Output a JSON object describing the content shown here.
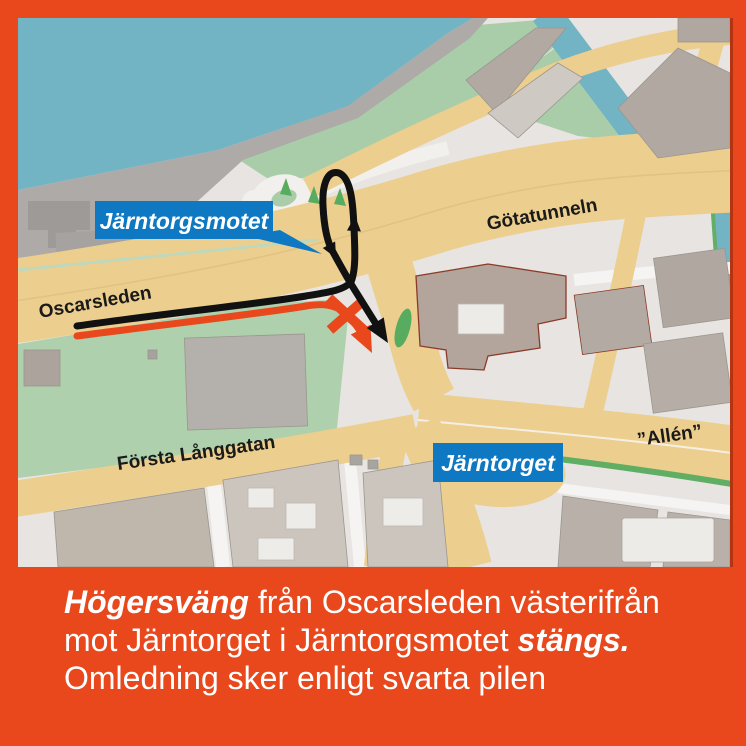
{
  "map": {
    "road_labels": {
      "oscarsleden": "Oscarsleden",
      "gotatunneln": "Götatunneln",
      "forsta_langgatan": "Första Långgatan",
      "allen": "”Allén”"
    },
    "callouts": {
      "jarntorgsmotet": "Järntorgsmotet",
      "jarntorget": "Järntorget"
    },
    "icons": {
      "closed_x": "closed-route-x-icon",
      "detour_arrow": "detour-arrow-icon"
    },
    "colors": {
      "frame_orange": "#E8481C",
      "callout_blue": "#0E78C2",
      "water_teal": "#72B4C3",
      "road_beige": "#ECCE8E",
      "green_sage": "#A9CDA9",
      "detour_black": "#111111"
    }
  },
  "caption": {
    "line1_bold": "Högersväng",
    "line1_rest": " från Oscarsleden västerifrån",
    "line2_pre": "mot Järntorget i Järntorgsmotet ",
    "line2_bold": "stängs.",
    "line3": "Omledning sker enligt svarta pilen"
  }
}
